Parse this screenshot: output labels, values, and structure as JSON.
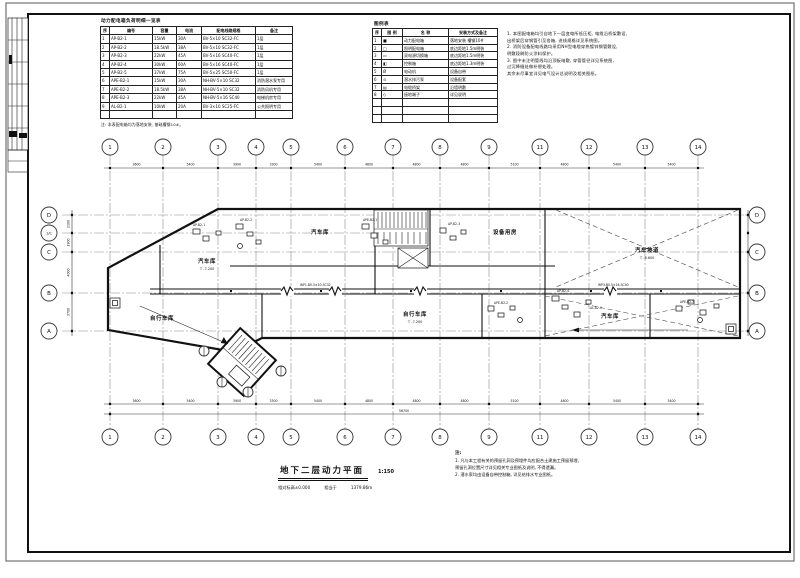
{
  "colors": {
    "line": "#1a1a1a",
    "grid_axis": "#8a8a8a",
    "paper": "#ffffff"
  },
  "tables": {
    "power": {
      "title": "动力配电箱负荷明细一览表",
      "widths": [
        9,
        43,
        24,
        25,
        54,
        37
      ],
      "header": [
        "序",
        "编号",
        "容量",
        "电流",
        "配电线路规格",
        "备注"
      ],
      "rows": [
        [
          "1",
          "AP-B2-1",
          "15kW",
          "30A",
          "BV-5×10 SC32-FC",
          "1层"
        ],
        [
          "2",
          "AP-B2-2",
          "18.5kW",
          "38A",
          "BV-5×10 SC32-FC",
          "1层"
        ],
        [
          "3",
          "AP-B2-3",
          "22kW",
          "45A",
          "BV-5×16 SC40-FC",
          "1层"
        ],
        [
          "4",
          "AP-B2-4",
          "30kW",
          "60A",
          "BV-5×16 SC40-FC",
          "1层"
        ],
        [
          "5",
          "AP-B2-5",
          "37kW",
          "75A",
          "BV-5×25 SC50-FC",
          "1层"
        ],
        [
          "6",
          "APE-B2-1",
          "15kW",
          "30A",
          "NH-BV-5×10 SC32",
          "消防潜水泵专用"
        ],
        [
          "7",
          "APE-B2-2",
          "18.5kW",
          "38A",
          "NH-BV-5×10 SC32",
          "消防风机专用"
        ],
        [
          "8",
          "APE-B2-3",
          "22kW",
          "45A",
          "NH-BV-5×16 SC40",
          "电梯机房专用"
        ],
        [
          "9",
          "AL-B2-1",
          "10kW",
          "20A",
          "BV-3×10 SC25-FC",
          "公共照明专用"
        ],
        [
          "",
          "",
          "",
          "",
          "",
          ""
        ]
      ],
      "note": "注: 本表配电箱均为落地安装, 基础槽钢10#。"
    },
    "legend": {
      "title": "图例表",
      "widths": [
        9,
        21,
        46,
        49
      ],
      "header": [
        "序",
        "图 例",
        "名 称",
        "安装方式及备注"
      ],
      "rows": [
        [
          "1",
          "■",
          "动力配电箱",
          "落地安装 槽钢10#"
        ],
        [
          "2",
          "□",
          "照明配电箱",
          "底边距地1.5m明装"
        ],
        [
          "3",
          "▭",
          "双电源切换箱",
          "底边距地1.5m明装"
        ],
        [
          "4",
          "◧",
          "控制箱",
          "底边距地1.3m明装"
        ],
        [
          "5",
          "Ø",
          "电动机",
          "设备自带"
        ],
        [
          "6",
          "⊙",
          "潜水排污泵",
          "设备配套"
        ],
        [
          "7",
          "▤",
          "电缆桥架",
          "沿墙明敷"
        ],
        [
          "8",
          "◇",
          "接地端子",
          "详见说明"
        ],
        [
          "",
          "",
          "",
          ""
        ],
        [
          "",
          "",
          "",
          ""
        ],
        [
          "",
          "",
          "",
          ""
        ]
      ]
    }
  },
  "notes_top": {
    "lines": [
      "1. 本图配电箱均引自地下一层变电所低压柜, 电缆沿桥架敷设,",
      "    出桥架后穿钢管引至各箱, 进线规格详见系统图。",
      "2. 消防设备配电线路均采用NH型电缆穿热镀锌钢管敷设,",
      "    明敷段刷防火涂料保护。",
      "3. 图中未注明管线均沿顶板暗敷, 穿管管径详见系统图,",
      "    过沉降缝处做补偿处理。",
      "其余未尽事宜详见电气设计总说明及相关图纸。"
    ]
  },
  "notes_bottom": {
    "header": "注:",
    "lines": [
      "1. 凡与本工程有关的预留孔洞及预埋件均应配合土建施工预留预埋,",
      "    预留孔洞位置尺寸详见相关专业图纸及说明, 不得遗漏。",
      "2. 潜水泵均由设备自带控制箱, 详见给排水专业图纸。"
    ]
  },
  "title_block": {
    "title": "地下二层动力平面",
    "scale": "1:150",
    "sub": [
      "相对标高±0.000",
      "相当于",
      "1379.86m"
    ]
  },
  "grid": {
    "cols": [
      {
        "label": "1",
        "x": 110
      },
      {
        "label": "2",
        "x": 163
      },
      {
        "label": "3",
        "x": 218
      },
      {
        "label": "4",
        "x": 256
      },
      {
        "label": "5",
        "x": 291
      },
      {
        "label": "6",
        "x": 345
      },
      {
        "label": "7",
        "x": 393
      },
      {
        "label": "8",
        "x": 440
      },
      {
        "label": "9",
        "x": 489
      },
      {
        "label": "11",
        "x": 540
      },
      {
        "label": "12",
        "x": 589
      },
      {
        "label": "13",
        "x": 645
      },
      {
        "label": "14",
        "x": 698
      }
    ],
    "rows_left": [
      {
        "label": "D",
        "y": 215,
        "x2": 745
      },
      {
        "label": "1/C",
        "y": 233,
        "x2": 430
      },
      {
        "label": "C",
        "y": 252,
        "x2": 745
      },
      {
        "label": "B",
        "y": 293,
        "x2": 745
      },
      {
        "label": "A",
        "y": 331,
        "x2": 745
      }
    ],
    "rows_right": [
      {
        "label": "D",
        "y": 215
      },
      {
        "label": "C",
        "y": 252
      },
      {
        "label": "B",
        "y": 293
      },
      {
        "label": "A",
        "y": 331
      }
    ]
  },
  "dims": {
    "top_values": [
      "3600",
      "5400",
      "3900",
      "3300",
      "5400",
      "4800",
      "4800",
      "4800",
      "5100",
      "4800",
      "5400",
      "5400"
    ],
    "bottom_values": [
      "3600",
      "5400",
      "3900",
      "3300",
      "5400",
      "4800",
      "4800",
      "4800",
      "5100",
      "4800",
      "5400",
      "5400"
    ],
    "overall": "56700",
    "side_values": [
      "2100",
      "1900",
      "4000",
      "3700"
    ]
  },
  "plan": {
    "rooms": [
      {
        "label": "汽车库",
        "x": 320,
        "y": 234,
        "elev": ""
      },
      {
        "label": "设备用房",
        "x": 505,
        "y": 234,
        "elev": ""
      },
      {
        "label": "汽车坡道",
        "x": 647,
        "y": 252,
        "elev": "-6.600"
      },
      {
        "label": "汽车库",
        "x": 207,
        "y": 263,
        "elev": "-7.200"
      },
      {
        "label": "自行车库",
        "x": 162,
        "y": 320,
        "elev": ""
      },
      {
        "label": "自行车库",
        "x": 415,
        "y": 316,
        "elev": "-7.200"
      },
      {
        "label": "汽车库",
        "x": 610,
        "y": 318,
        "elev": ""
      }
    ],
    "tags": [
      {
        "t": "AP-B2-1",
        "x": 193,
        "y": 226
      },
      {
        "t": "AP-B2-2",
        "x": 240,
        "y": 221
      },
      {
        "t": "APE-B2-1",
        "x": 363,
        "y": 221
      },
      {
        "t": "AP-B2-3",
        "x": 448,
        "y": 225
      },
      {
        "t": "APE-B2-2",
        "x": 494,
        "y": 304
      },
      {
        "t": "AP-B2-4",
        "x": 557,
        "y": 292
      },
      {
        "t": "AL-B2-1",
        "x": 590,
        "y": 309
      },
      {
        "t": "APE-B2-3",
        "x": 680,
        "y": 303
      },
      {
        "t": "WP1-BV-5×10-SC32",
        "x": 300,
        "y": 286
      },
      {
        "t": "WP3-BV-5×16-SC40",
        "x": 598,
        "y": 286
      }
    ],
    "sub_axes": [
      {
        "x": 204,
        "y": 351
      },
      {
        "x": 222,
        "y": 382
      },
      {
        "x": 248,
        "y": 392
      },
      {
        "x": 281,
        "y": 371
      }
    ]
  }
}
